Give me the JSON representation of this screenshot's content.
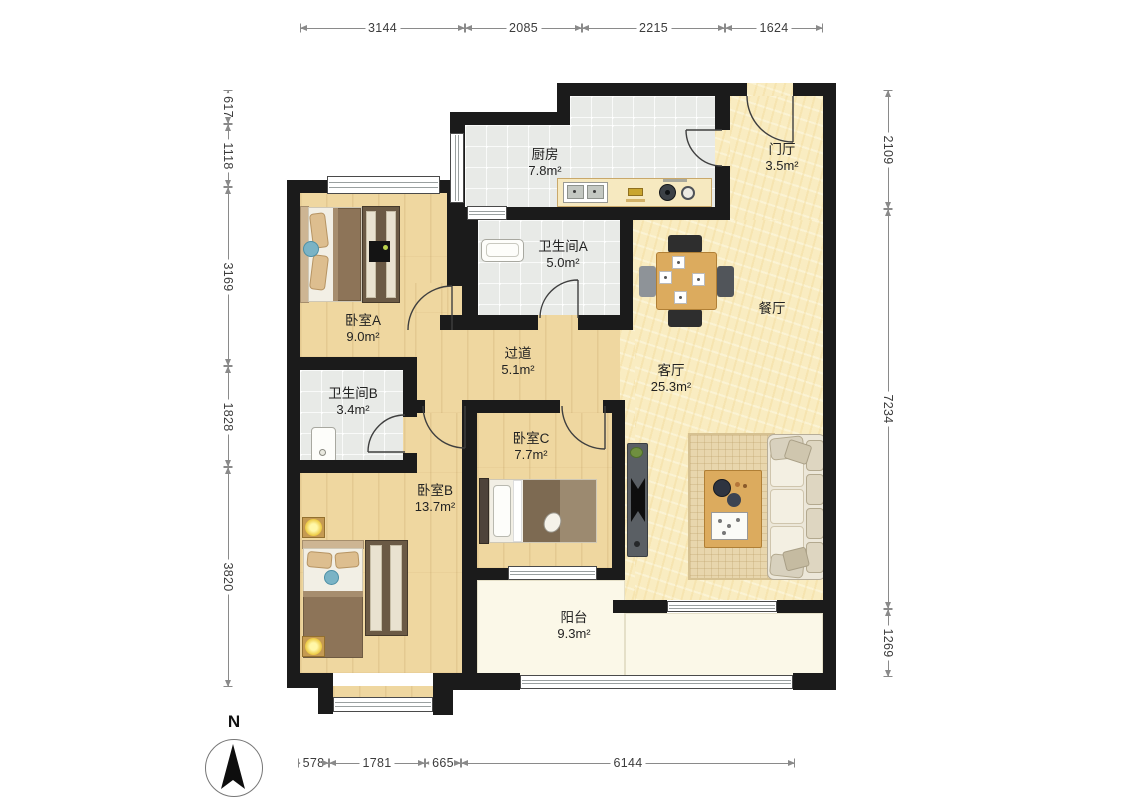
{
  "rooms": {
    "kitchen": {
      "name": "厨房",
      "area": "7.8m²"
    },
    "foyer": {
      "name": "门厅",
      "area": "3.5m²"
    },
    "bathroom_a": {
      "name": "卫生间A",
      "area": "5.0m²"
    },
    "dining": {
      "name": "餐厅",
      "area": ""
    },
    "bedroom_a": {
      "name": "卧室A",
      "area": "9.0m²"
    },
    "hallway": {
      "name": "过道",
      "area": "5.1m²"
    },
    "living": {
      "name": "客厅",
      "area": "25.3m²"
    },
    "bathroom_b": {
      "name": "卫生间B",
      "area": "3.4m²"
    },
    "bedroom_c": {
      "name": "卧室C",
      "area": "7.7m²"
    },
    "bedroom_b": {
      "name": "卧室B",
      "area": "13.7m²"
    },
    "balcony": {
      "name": "阳台",
      "area": "9.3m²"
    }
  },
  "dimensions": {
    "top": [
      "3144",
      "2085",
      "2215",
      "1624"
    ],
    "bottom": [
      "578",
      "1781",
      "665",
      "6144"
    ],
    "left": [
      "617",
      "1118",
      "3169",
      "1828",
      "3820"
    ],
    "right": [
      "2109",
      "7234",
      "1269"
    ]
  },
  "compass": {
    "label": "N"
  },
  "colors": {
    "wall": "#1b1b1b",
    "wood_floor": "#efd7a0",
    "tile_floor": "#e8eae7",
    "warm_floor": "#f9ecc1",
    "balcony_floor": "#fbf8e8",
    "counter_wood": "#dcab5e",
    "dim_line": "#8a8a8a"
  }
}
